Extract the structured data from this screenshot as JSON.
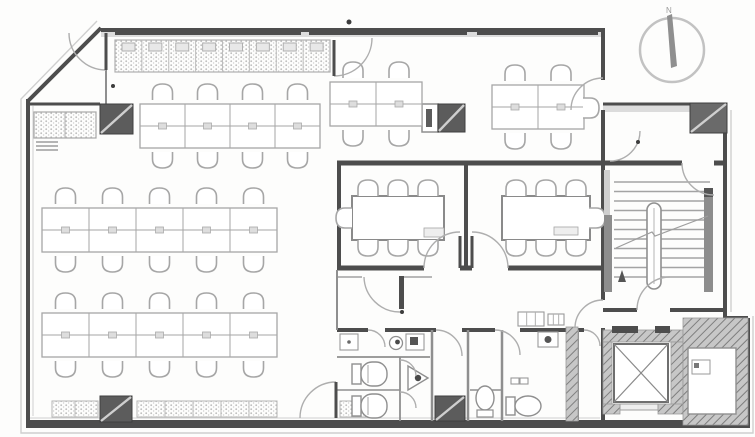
{
  "plan": {
    "w": 755,
    "h": 437,
    "colors": {
      "wall": "#4d4d4d",
      "thin": "#8f8f8f",
      "furn": "#a6a6a6",
      "faint": "#cfcfcf",
      "band": "#dcdcdc",
      "column": "#5c5c5c",
      "arc": "#aeaeae",
      "dot": "#3d3d3d",
      "hatchline": "#7e7e7e",
      "hatchbg": "#c7c7c7"
    },
    "outer": {
      "offset_path": "M 97,21 L 21,99 L 21,433 L 753,433 L 753,316 M 731,312 L 731,110",
      "boundary": [
        {
          "x1": 28,
          "y1": 101,
          "x2": 101,
          "y2": 28,
          "w": 4
        },
        {
          "x1": 101,
          "y1": 30,
          "x2": 603,
          "y2": 30,
          "w": 4
        },
        {
          "x1": 603,
          "y1": 28,
          "x2": 603,
          "y2": 80,
          "w": 4
        },
        {
          "x1": 603,
          "y1": 110,
          "x2": 603,
          "y2": 163,
          "w": 4
        },
        {
          "x1": 603,
          "y1": 104,
          "x2": 725,
          "y2": 104,
          "w": 3
        },
        {
          "x1": 725,
          "y1": 104,
          "x2": 725,
          "y2": 318,
          "w": 4
        },
        {
          "x1": 725,
          "y1": 318,
          "x2": 748,
          "y2": 318,
          "w": 4
        },
        {
          "x1": 748,
          "y1": 318,
          "x2": 748,
          "y2": 426,
          "w": 4
        },
        {
          "x1": 28,
          "y1": 99,
          "x2": 28,
          "y2": 424,
          "w": 4
        }
      ],
      "top_band": {
        "x": 101,
        "y": 31,
        "w": 502,
        "h": 6,
        "dark_segs": [
          [
            115,
            186
          ],
          [
            309,
            158
          ],
          [
            477,
            121
          ]
        ]
      },
      "right_band": {
        "x": 603,
        "y": 105,
        "w": 122,
        "h": 7
      },
      "bottom_band": {
        "x": 26,
        "y": 420,
        "w": 724,
        "h": 8
      }
    },
    "walls": [
      {
        "x1": 337,
        "y1": 163,
        "x2": 603,
        "y2": 163,
        "w": 5
      },
      {
        "x1": 603,
        "y1": 163,
        "x2": 682,
        "y2": 163,
        "w": 5
      },
      {
        "x1": 714,
        "y1": 163,
        "x2": 725,
        "y2": 163,
        "w": 5
      },
      {
        "x1": 339,
        "y1": 163,
        "x2": 339,
        "y2": 270,
        "w": 4
      },
      {
        "x1": 466,
        "y1": 163,
        "x2": 466,
        "y2": 270,
        "w": 4
      },
      {
        "x1": 337,
        "y1": 268,
        "x2": 424,
        "y2": 268,
        "w": 5
      },
      {
        "x1": 460,
        "y1": 268,
        "x2": 472,
        "y2": 268,
        "w": 5
      },
      {
        "x1": 508,
        "y1": 268,
        "x2": 603,
        "y2": 268,
        "w": 5
      },
      {
        "x1": 603,
        "y1": 163,
        "x2": 603,
        "y2": 300,
        "w": 4
      },
      {
        "x1": 603,
        "y1": 328,
        "x2": 603,
        "y2": 424,
        "w": 4
      },
      {
        "x1": 603,
        "y1": 310,
        "x2": 637,
        "y2": 310,
        "w": 4
      },
      {
        "x1": 670,
        "y1": 310,
        "x2": 725,
        "y2": 310,
        "w": 4
      },
      {
        "x1": 337,
        "y1": 330,
        "x2": 368,
        "y2": 330,
        "w": 4
      },
      {
        "x1": 385,
        "y1": 330,
        "x2": 436,
        "y2": 330,
        "w": 4
      },
      {
        "x1": 462,
        "y1": 330,
        "x2": 495,
        "y2": 330,
        "w": 4
      },
      {
        "x1": 520,
        "y1": 330,
        "x2": 584,
        "y2": 330,
        "w": 4
      },
      {
        "x1": 28,
        "y1": 104,
        "x2": 100,
        "y2": 104,
        "w": 3
      }
    ],
    "thin_walls": [
      {
        "x1": 106,
        "y1": 68,
        "x2": 106,
        "y2": 104,
        "w": 2
      },
      {
        "x1": 337,
        "y1": 270,
        "x2": 337,
        "y2": 330,
        "w": 2
      },
      {
        "x1": 432,
        "y1": 330,
        "x2": 432,
        "y2": 421,
        "w": 2.5
      },
      {
        "x1": 468,
        "y1": 330,
        "x2": 468,
        "y2": 421,
        "w": 2.5
      },
      {
        "x1": 502,
        "y1": 330,
        "x2": 502,
        "y2": 421,
        "w": 2.5
      },
      {
        "x1": 578,
        "y1": 330,
        "x2": 578,
        "y2": 421,
        "w": 2
      },
      {
        "x1": 337,
        "y1": 357,
        "x2": 430,
        "y2": 357,
        "w": 1.8
      },
      {
        "x1": 400,
        "y1": 357,
        "x2": 400,
        "y2": 421,
        "w": 1.8
      },
      {
        "x1": 337,
        "y1": 390,
        "x2": 400,
        "y2": 390,
        "w": 1.5
      },
      {
        "x1": 470,
        "y1": 390,
        "x2": 502,
        "y2": 390,
        "w": 1.5
      },
      {
        "x1": 337,
        "y1": 277,
        "x2": 362,
        "y2": 277,
        "w": 1.2
      },
      {
        "x1": 404,
        "y1": 277,
        "x2": 432,
        "y2": 277,
        "w": 1.2
      }
    ],
    "guides": [
      {
        "x1": 33,
        "y1": 106,
        "x2": 33,
        "y2": 416
      },
      {
        "x1": 30,
        "y1": 418,
        "x2": 600,
        "y2": 418
      }
    ],
    "hatch_areas": [
      {
        "x": 603,
        "y": 330,
        "w": 80,
        "h": 12
      },
      {
        "x": 603,
        "y": 342,
        "w": 9,
        "h": 70
      },
      {
        "x": 671,
        "y": 342,
        "w": 12,
        "h": 70
      },
      {
        "x": 603,
        "y": 404,
        "w": 17,
        "h": 10
      },
      {
        "x": 658,
        "y": 404,
        "w": 25,
        "h": 10
      },
      {
        "x": 566,
        "y": 327,
        "w": 12,
        "h": 94
      },
      {
        "x": 683,
        "y": 318,
        "w": 65,
        "h": 107
      }
    ],
    "columns": [
      {
        "x": 100,
        "y": 104,
        "w": 33,
        "h": 30,
        "type": "solid"
      },
      {
        "x": 422,
        "y": 104,
        "w": 16,
        "h": 28,
        "type": "open"
      },
      {
        "x": 438,
        "y": 104,
        "w": 27,
        "h": 28,
        "type": "solid"
      },
      {
        "x": 690,
        "y": 103,
        "w": 37,
        "h": 30,
        "type": "hatchcol"
      },
      {
        "x": 100,
        "y": 396,
        "w": 32,
        "h": 26,
        "type": "solid"
      },
      {
        "x": 435,
        "y": 396,
        "w": 30,
        "h": 25,
        "type": "solid"
      }
    ],
    "stipple_areas": [
      {
        "x": 52,
        "y": 401,
        "w": 46,
        "h": 16,
        "div": 1
      },
      {
        "x": 137,
        "y": 401,
        "w": 140,
        "h": 16,
        "div": 4
      },
      {
        "x": 340,
        "y": 401,
        "w": 32,
        "h": 16,
        "div": 1
      }
    ],
    "bench": {
      "x": 115,
      "y": 40,
      "w": 215,
      "h": 32,
      "div": 8
    },
    "cabinet": {
      "x": 34,
      "y": 112,
      "w": 62,
      "h": 26
    },
    "desk_clusters": [
      {
        "x": 140,
        "y": 104,
        "cols": 4,
        "cw": 45,
        "ch": 22
      },
      {
        "x": 330,
        "y": 82,
        "cols": 2,
        "cw": 46,
        "ch": 22
      },
      {
        "x": 492,
        "y": 85,
        "cols": 2,
        "cw": 46,
        "ch": 22,
        "side": {
          "cx": 590,
          "cy": 108,
          "rot": 90
        }
      },
      {
        "x": 42,
        "y": 208,
        "cols": 5,
        "cw": 47,
        "ch": 22
      },
      {
        "x": 42,
        "y": 313,
        "cols": 5,
        "cw": 47,
        "ch": 22
      }
    ],
    "meeting_rooms": [
      {
        "table": {
          "x": 352,
          "y": 196,
          "w": 92,
          "h": 44
        },
        "chairs_top": [
          368,
          398,
          428
        ],
        "cy_top": 189,
        "chairs_bottom": [
          368,
          398,
          428
        ],
        "cy_bottom": 247,
        "end": {
          "cx": 345,
          "cy": 218,
          "rot": 270
        },
        "phone": {
          "x": 424,
          "y": 228,
          "w": 20,
          "h": 9
        }
      },
      {
        "table": {
          "x": 502,
          "y": 196,
          "w": 88,
          "h": 44
        },
        "chairs_top": [
          516,
          546,
          576
        ],
        "cy_top": 189,
        "chairs_bottom": [
          516,
          546,
          576
        ],
        "cy_bottom": 247,
        "end": {
          "cx": 596,
          "cy": 218,
          "rot": 90
        },
        "phone": {
          "x": 554,
          "y": 227,
          "w": 24,
          "h": 8
        }
      }
    ],
    "stairs": {
      "tread_x1": 614,
      "tread_x2": 710,
      "tread_y": 182,
      "tread_step": 9.5,
      "tread_count": 11,
      "newel": {
        "x": 647,
        "y": 203,
        "w": 14,
        "h": 86,
        "rx": 7
      },
      "rails": [
        {
          "x": 604,
          "y": 215,
          "w": 8,
          "h": 77
        },
        {
          "x": 704,
          "y": 197,
          "w": 9,
          "h": 95
        }
      ],
      "light": {
        "x": 604,
        "y": 170,
        "w": 6,
        "h": 45
      },
      "dark_block": {
        "x": 704,
        "y": 188,
        "w": 9,
        "h": 9
      },
      "breakline": [
        [
          616,
          248
        ],
        [
          652,
          232
        ],
        [
          655,
          236
        ],
        [
          708,
          216
        ]
      ],
      "arrow": [
        [
          618,
          282
        ],
        [
          626,
          282
        ],
        [
          622,
          270
        ]
      ]
    },
    "elevator": {
      "car": {
        "x": 614,
        "y": 344,
        "w": 54,
        "h": 58
      },
      "sill": {
        "x": 620,
        "y": 404,
        "w": 38,
        "h": 6
      },
      "jambs": [
        {
          "x": 612,
          "y": 326,
          "w": 26,
          "h": 7
        },
        {
          "x": 655,
          "y": 326,
          "w": 15,
          "h": 7
        }
      ]
    },
    "right_room": {
      "inner": {
        "x": 688,
        "y": 348,
        "w": 48,
        "h": 66
      },
      "fixture": {
        "x": 692,
        "y": 360,
        "w": 18,
        "h": 14
      },
      "mark": {
        "x": 694,
        "y": 363,
        "w": 5,
        "h": 5
      }
    },
    "restroom": {
      "toilets": [
        {
          "type": "h-left",
          "x": 352,
          "y": 362
        },
        {
          "type": "h-left",
          "x": 352,
          "y": 394
        },
        {
          "type": "v",
          "cx": 485,
          "cy": 398
        },
        {
          "type": "h-right",
          "x": 506,
          "y": 396
        }
      ],
      "urinal": {
        "pts": [
          [
            408,
            366
          ],
          [
            408,
            390
          ],
          [
            428,
            378
          ]
        ],
        "dot": [
          418,
          378
        ]
      },
      "sinks": [
        {
          "kind": "basin",
          "x": 340,
          "y": 334,
          "w": 18,
          "h": 16
        },
        {
          "kind": "spiral",
          "cx": 396,
          "cy": 343
        },
        {
          "kind": "unit",
          "x": 406,
          "y": 334,
          "w": 18,
          "h": 16
        },
        {
          "kind": "unit2",
          "x": 538,
          "y": 332,
          "w": 20,
          "h": 15
        },
        {
          "kind": "counter",
          "x": 518,
          "y": 312,
          "w": 26,
          "h": 14
        },
        {
          "kind": "counter",
          "x": 548,
          "y": 314,
          "w": 16,
          "h": 11
        },
        {
          "kind": "tiny",
          "x": 511,
          "y": 378,
          "w": 8,
          "h": 6
        },
        {
          "kind": "tiny",
          "x": 520,
          "y": 378,
          "w": 8,
          "h": 6
        }
      ]
    },
    "doors": [
      {
        "leaf": [
          106,
          33,
          106,
          70
        ],
        "arc": "M106,70 A37,37 0 0 1 69,33"
      },
      {
        "leaf": [
          334,
          40,
          334,
          76
        ],
        "arc": "M334,76 A38,38 0 0 0 372,38"
      },
      {
        "arc": "M571,110 A32,32 0 0 1 603,78"
      },
      {
        "arc": "M640,131 A30,30 0 0 1 610,161"
      },
      {
        "leaf": [
          460,
          236,
          460,
          268
        ],
        "arc": "M424,268 A36,36 0 0 1 460,232"
      },
      {
        "leaf": [
          472,
          236,
          472,
          268
        ],
        "arc": "M508,268 A36,36 0 0 0 472,232"
      },
      {
        "leafRect": {
          "x": 399,
          "y": 276,
          "w": 5,
          "h": 33
        },
        "arc": "M364,277 A36,36 0 0 0 400,312"
      },
      {
        "leaf": [
          336,
          382,
          336,
          418
        ],
        "arc": "M300,418 A36,36 0 0 1 336,382"
      },
      {
        "arc": "M400,360 A16,16 0 0 1 416,376"
      },
      {
        "arc": "M400,392 A16,16 0 0 1 416,408"
      },
      {
        "arc": "M368,330 A17,17 0 0 1 385,347"
      },
      {
        "arc": "M436,330 A26,26 0 0 1 462,356"
      },
      {
        "arc": "M495,330 A25,25 0 0 1 520,355"
      },
      {
        "arc": "M584,330 A16,16 0 0 1 600,346"
      },
      {
        "arc": "M682,163 A32,32 0 0 0 714,195"
      },
      {
        "arc": "M637,310 A33,33 0 0 1 670,277"
      },
      {
        "arc": "M603,300 A28,28 0 0 0 575,328"
      }
    ],
    "dots": [
      [
        349,
        22,
        2.5
      ],
      [
        113,
        86,
        2
      ],
      [
        638,
        142,
        2
      ],
      [
        402,
        312,
        2
      ]
    ],
    "compass": {
      "cx": 672,
      "cy": 50,
      "r": 32,
      "label": "N",
      "needle": [
        [
          667,
          16
        ],
        [
          672,
          14
        ],
        [
          677,
          66
        ],
        [
          671,
          68
        ]
      ]
    }
  }
}
